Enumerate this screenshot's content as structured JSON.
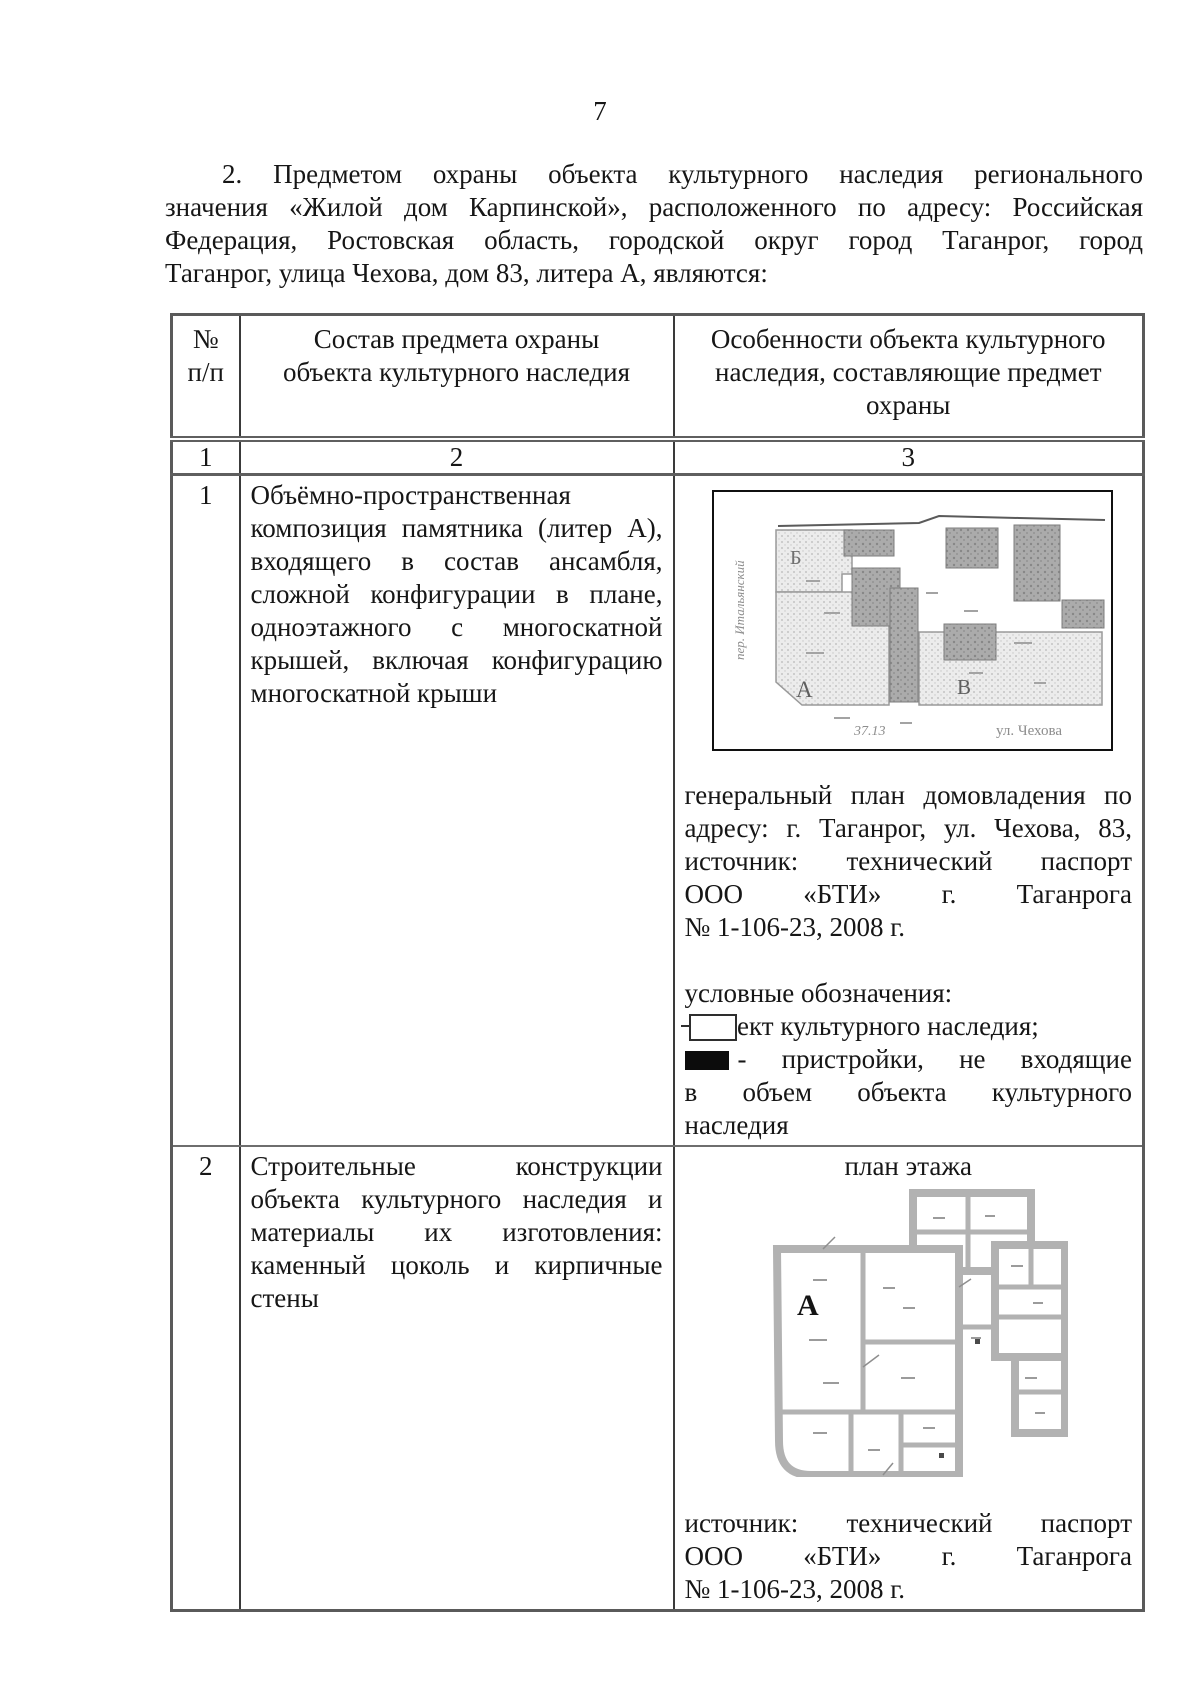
{
  "page_number": "7",
  "intro": {
    "lines": [
      "2. Предметом охраны объекта культурного наследия регионального",
      "значения «Жилой дом Карпинской», расположенного по адресу: Российская",
      "Федерация, Ростовская область, городской округ город Таганрог, город",
      "Таганрог, улица Чехова, дом 83, литера А, являются:"
    ]
  },
  "table": {
    "head": {
      "col1_lines": [
        "№",
        "п/п"
      ],
      "col2_lines": [
        "Состав предмета охраны",
        "объекта культурного наследия"
      ],
      "col3_lines": [
        "Особенности объекта культурного",
        "наследия, составляющие предмет",
        "охраны"
      ]
    },
    "index_row": [
      "1",
      "2",
      "3"
    ],
    "rows": [
      {
        "num": "1",
        "subject_lines": [
          "Объёмно-пространственная",
          "композиция памятника (литер А),",
          "входящего в состав ансамбля,",
          "сложной конфигурации в плане,",
          "одноэтажного с многоскатной",
          "крышей, включая конфигурацию",
          "многоскатной крыши"
        ],
        "site_plan": {
          "building_labels": [
            "Б",
            "А",
            "В"
          ],
          "street_left": "пер. Итальянский",
          "street_bottom": "ул. Чехова",
          "dim_note": "37.13"
        },
        "caption_lines": [
          "генеральный план домовладения по",
          "адресу: г. Таганрог, ул. Чехова, 83,",
          "источник: технический паспорт",
          "ООО «БТИ» г. Таганрога",
          "№ 1-106-23, 2008 г."
        ],
        "legend_title": "условные обозначения:",
        "legend": [
          {
            "symbol": "outline-rect",
            "label": "объект культурного наследия;"
          },
          {
            "symbol": "filled-rect",
            "label_lines": [
              "- пристройки, не входящие",
              "в объем объекта культурного",
              "наследия"
            ]
          }
        ]
      },
      {
        "num": "2",
        "subject_lines": [
          "Строительные конструкции",
          "объекта культурного наследия и",
          "материалы их изготовления:",
          "каменный цоколь и кирпичные",
          "стены"
        ],
        "plan_title": "план этажа",
        "floor_plan": {
          "building_label": "А"
        },
        "caption_lines": [
          "источник: технический паспорт",
          "ООО «БТИ» г. Таганрога",
          "№ 1-106-23, 2008 г."
        ]
      }
    ]
  }
}
